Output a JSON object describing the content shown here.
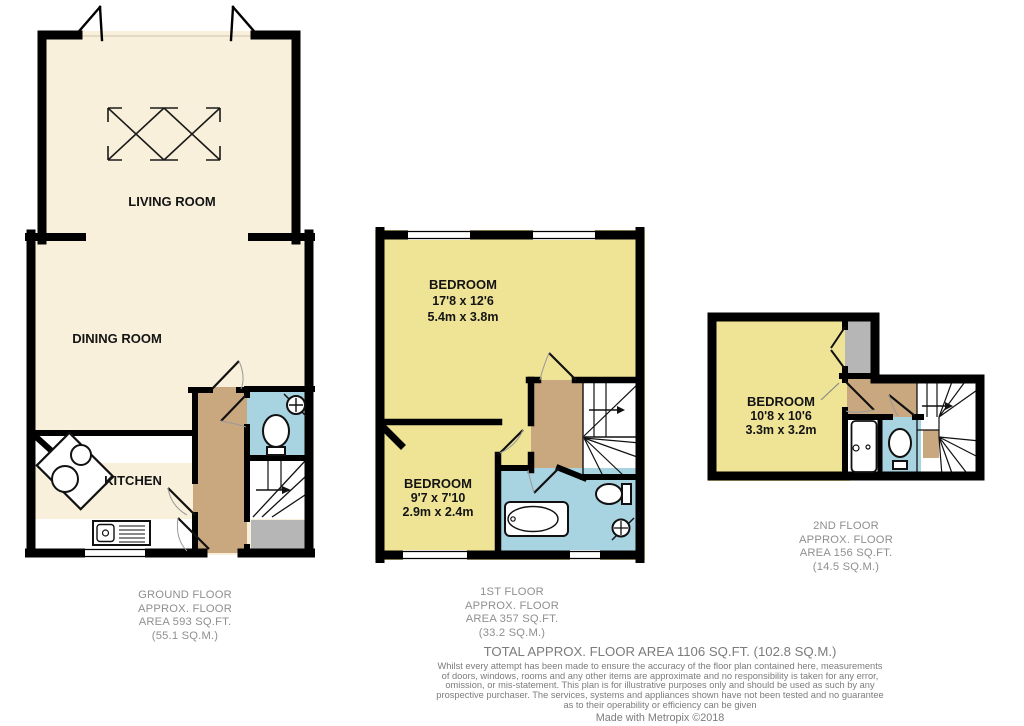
{
  "plans": {
    "ground": {
      "rooms": {
        "living": "LIVING ROOM",
        "dining": "DINING ROOM",
        "kitchen": "KITCHEN"
      },
      "caption": [
        "GROUND FLOOR",
        "APPROX. FLOOR",
        "AREA 593 SQ.FT.",
        "(55.1 SQ.M.)"
      ]
    },
    "first": {
      "bedroom1": [
        "BEDROOM",
        "17'8 x 12'6",
        "5.4m x 3.8m"
      ],
      "bedroom2": [
        "BEDROOM",
        "9'7 x 7'10",
        "2.9m x 2.4m"
      ],
      "caption": [
        "1ST FLOOR",
        "APPROX. FLOOR",
        "AREA 357 SQ.FT.",
        "(33.2 SQ.M.)"
      ]
    },
    "second": {
      "bedroom": [
        "BEDROOM",
        "10'8 x 10'6",
        "3.3m x 3.2m"
      ],
      "caption": [
        "2ND FLOOR",
        "APPROX. FLOOR",
        "AREA 156 SQ.FT.",
        "(14.5 SQ.M.)"
      ]
    }
  },
  "footer": {
    "total": "TOTAL APPROX. FLOOR AREA 1106 SQ.FT. (102.8 SQ.M.)",
    "disclaimer": [
      "Whilst every attempt has been made to ensure the accuracy of the floor plan contained here, measurements",
      "of doors, windows, rooms and any other items are approximate and no responsibility is taken for any error,",
      "omission, or mis-statement. This plan is for illustrative purposes only and should be used as such by any",
      "prospective purchaser. The services, systems and appliances shown have not been tested and no guarantee",
      "as to their operability or efficiency can be given"
    ],
    "credit": "Made with Metropix ©2018"
  },
  "colors": {
    "wall": "#000000",
    "ground_floor_rooms": "#f8f0db",
    "bedrooms": "#efe496",
    "hallway_landing": "#c9a87f",
    "bathrooms": "#a8d4e1",
    "mat_closet": "#b6b6b6"
  }
}
